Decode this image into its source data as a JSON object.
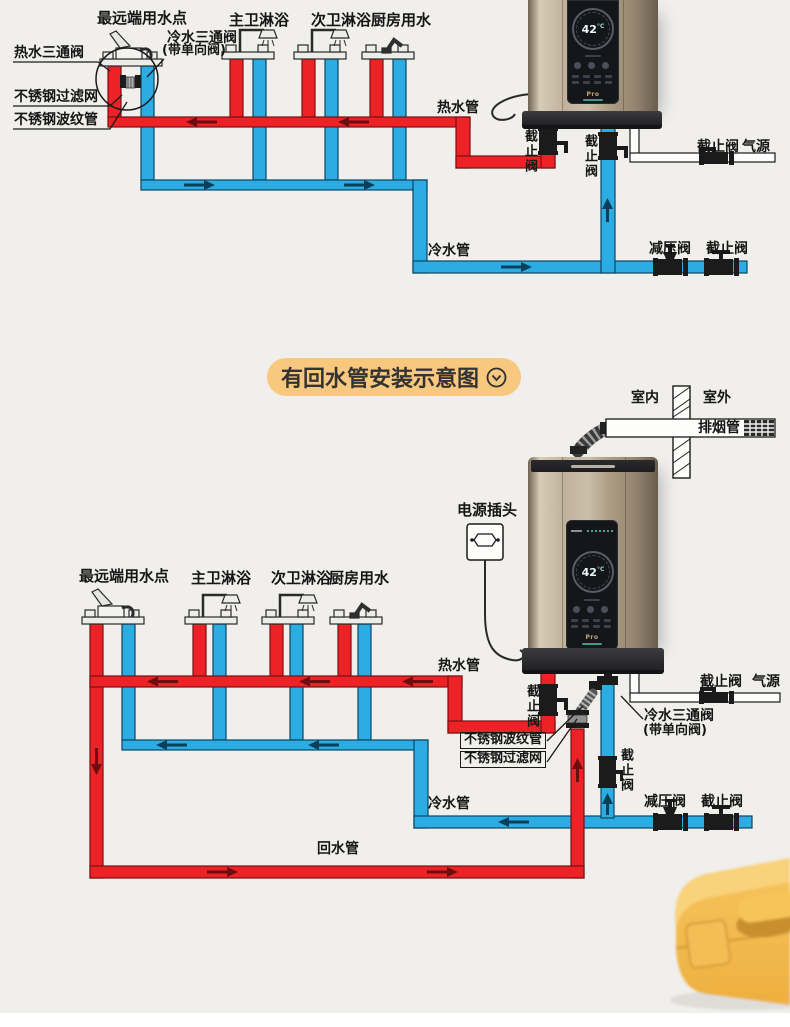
{
  "colors": {
    "hot_pipe": "#EC2227",
    "cold_pipe": "#2BADE3",
    "background": "#F0EFEC",
    "title_pill": "#F8C87E"
  },
  "section_title": "有回水管安装示意图",
  "d1": {
    "labels": {
      "farthest_point": "最远端用水点",
      "master_shower": "主卫淋浴",
      "second_shower": "次卫淋浴",
      "kitchen": "厨房用水",
      "hot_tee_valve": "热水三通阀",
      "cold_tee_valve": "冷水三通阀",
      "cold_tee_note": "(带单向阀)",
      "filter": "不锈钢过滤网",
      "corrugated": "不锈钢波纹管",
      "hot_pipe": "热水管",
      "cold_pipe": "冷水管",
      "stop_valve_hot": "截止阀",
      "stop_valve_cold": "截止阀",
      "stop_valve_gas": "截止阀",
      "gas_source": "气源",
      "pressure_valve": "减压阀",
      "stop_valve_main": "截止阀"
    },
    "heater": {
      "temp": "42",
      "unit": "°C",
      "brand": "Pro"
    }
  },
  "d2": {
    "labels": {
      "indoor": "室内",
      "outdoor": "室外",
      "exhaust_pipe": "排烟管",
      "power_plug": "电源插头",
      "farthest_point": "最远端用水点",
      "master_shower": "主卫淋浴",
      "second_shower": "次卫淋浴",
      "kitchen": "厨房用水",
      "hot_pipe": "热水管",
      "cold_pipe": "冷水管",
      "return_pipe": "回水管",
      "stop_valve_hot": "截止阀",
      "stop_valve_cold": "截止阀",
      "stop_valve_gas": "截止阀",
      "gas_source": "气源",
      "pressure_valve": "减压阀",
      "stop_valve_main": "截止阀",
      "cold_tee_valve": "冷水三通阀",
      "cold_tee_note": "(带单向阀)",
      "corrugated": "不锈钢波纹管",
      "filter": "不锈钢过滤网"
    },
    "heater": {
      "temp": "42",
      "unit": "°C",
      "brand": "Pro"
    }
  }
}
